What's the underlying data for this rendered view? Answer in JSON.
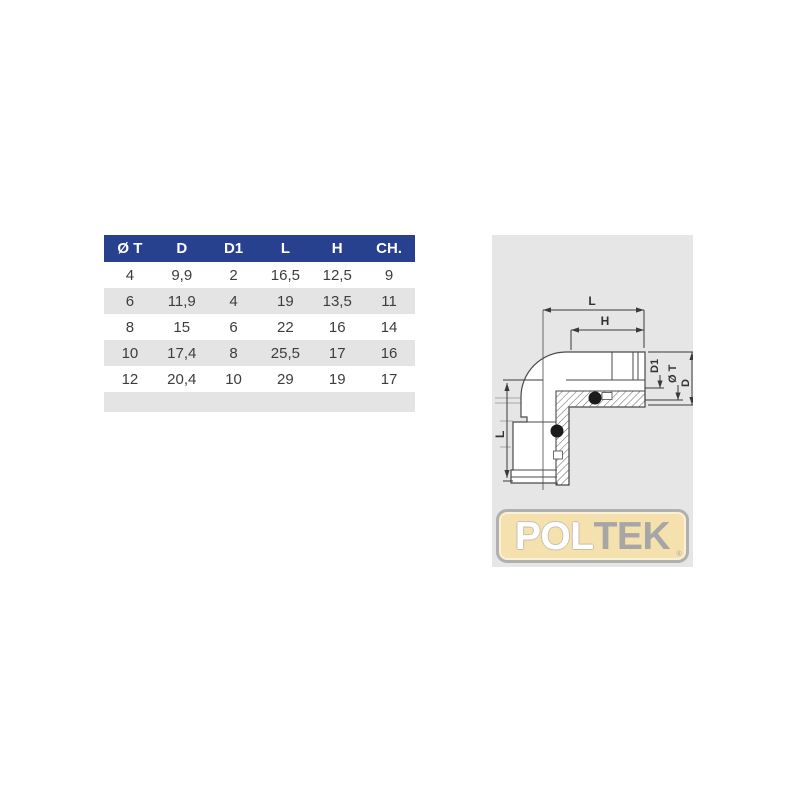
{
  "table": {
    "headers": [
      "Ø T",
      "D",
      "D1",
      "L",
      "H",
      "CH."
    ],
    "rows": [
      [
        "4",
        "9,9",
        "2",
        "16,5",
        "12,5",
        "9"
      ],
      [
        "6",
        "11,9",
        "4",
        "19",
        "13,5",
        "11"
      ],
      [
        "8",
        "15",
        "6",
        "22",
        "16",
        "14"
      ],
      [
        "10",
        "17,4",
        "8",
        "25,5",
        "17",
        "16"
      ],
      [
        "12",
        "20,4",
        "10",
        "29",
        "19",
        "17"
      ]
    ],
    "footer_row": [
      "",
      "",
      "",
      "",
      "",
      ""
    ],
    "colors": {
      "header_bg": "#28418f",
      "header_text": "#ffffff",
      "row_alt_bg": "#e4e4e4",
      "cell_text": "#3d3d3d"
    }
  },
  "diagram": {
    "description": "cross-section drawing of 90-degree elbow push-in fitting",
    "panel_bg": "#e6e6e6",
    "dim_labels": {
      "top_length": "L",
      "top_h": "H",
      "left_length": "L",
      "d1": "D1",
      "tube_dia": "Ø T",
      "outer_dia": "D"
    }
  },
  "logo": {
    "part1": "POL",
    "part2": "TEK",
    "registered": "®",
    "colors": {
      "background": "#f4e1ad",
      "border": "#b0b0b0",
      "part1_text": "#ffffff",
      "part2_text": "#a6a6a6"
    }
  }
}
